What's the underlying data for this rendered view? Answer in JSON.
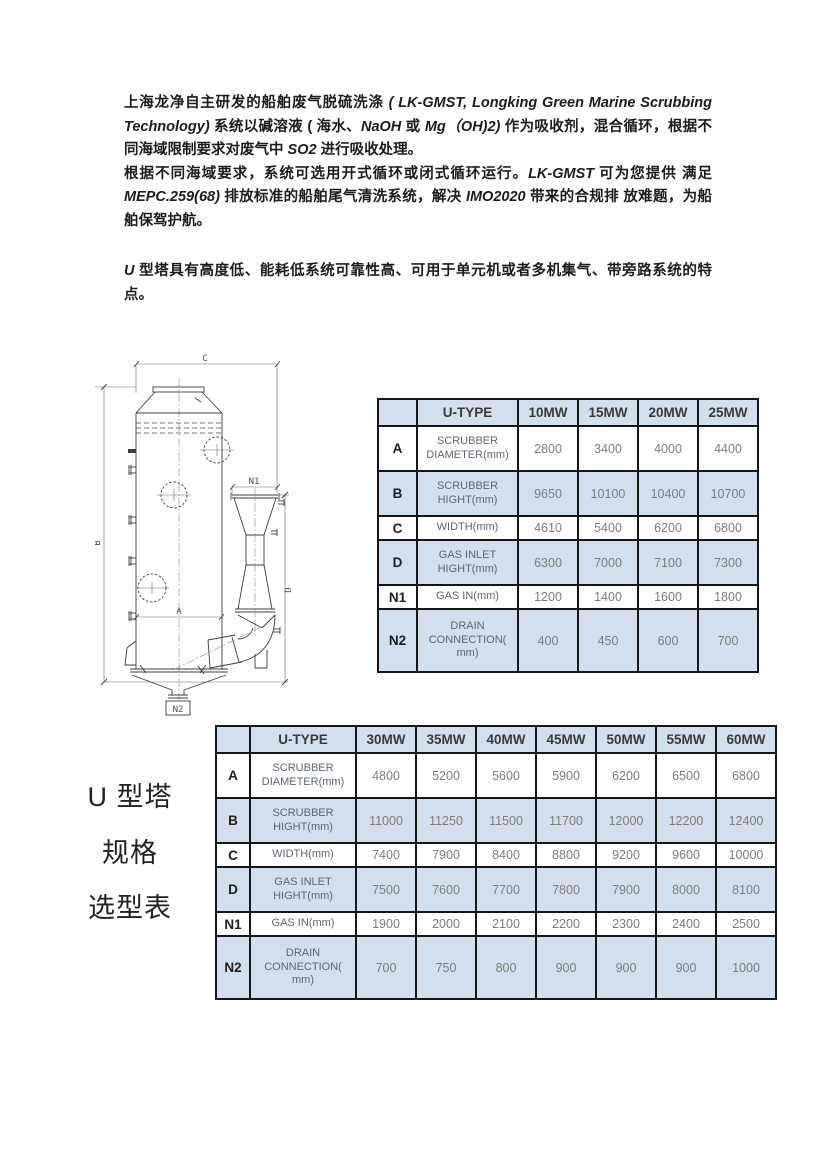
{
  "colors": {
    "table_header_bg": "#d3dfed",
    "shaded_row_bg": "#d3dfed",
    "table_border": "#161616",
    "body_text": "#1c1c1c",
    "value_text": "#7c7c7c"
  },
  "paragraphs": [
    {
      "segments": [
        {
          "t": "上海龙净自主研发的船舶废气脱硫洗涤 ",
          "i": false
        },
        {
          "t": "( LK-GMST, Longking Green Marine Scrubbing Technology)",
          "i": true
        },
        {
          "t": " 系统以碱溶液 ( 海水、",
          "i": false
        },
        {
          "t": "NaOH",
          "i": true
        },
        {
          "t": " 或 ",
          "i": false
        },
        {
          "t": "Mg（OH)2)",
          "i": true
        },
        {
          "t": " 作为吸收剂，混合循环，根据不同海域限制要求对废气中 ",
          "i": false
        },
        {
          "t": "SO2",
          "i": true
        },
        {
          "t": " 进行吸收处理。",
          "i": false
        }
      ]
    },
    {
      "segments": [
        {
          "t": "根据不同海域要求，系统可选用开式循环或闭式循环运行。",
          "i": false
        },
        {
          "t": "LK-GMST",
          "i": true
        },
        {
          "t": " 可为您提供 满足 ",
          "i": false
        },
        {
          "t": "MEPC.259(68)",
          "i": true
        },
        {
          "t": " 排放标准的船舶尾气清洗系统，解决 ",
          "i": false
        },
        {
          "t": "IMO2020",
          "i": true
        },
        {
          "t": " 带来的合规排 放难题，为船舶保驾护航。",
          "i": false
        }
      ]
    },
    {
      "segments": [
        {
          "t": "U",
          "i": true
        },
        {
          "t": " 型塔具有高度低、能耗低系统可靠性高、可用于单元机或者多机集气、带旁路系统的特点。",
          "i": false
        }
      ]
    }
  ],
  "drawing": {
    "labels": {
      "a": "A",
      "b": "B",
      "c": "C",
      "d": "D",
      "n1": "N1",
      "n2": "N2"
    }
  },
  "side_label": {
    "lines": [
      "U 型塔",
      "规格",
      "选型表"
    ]
  },
  "table1": {
    "columns": [
      "",
      "U-TYPE",
      "10MW",
      "15MW",
      "20MW",
      "25MW"
    ],
    "rows": [
      {
        "key": "A",
        "label": "SCRUBBER DIAMETER(mm)",
        "values": [
          "2800",
          "3400",
          "4000",
          "4400"
        ],
        "shaded": false
      },
      {
        "key": "B",
        "label": "SCRUBBER HIGHT(mm)",
        "values": [
          "9650",
          "10100",
          "10400",
          "10700"
        ],
        "shaded": true
      },
      {
        "key": "C",
        "label": "WIDTH(mm)",
        "values": [
          "4610",
          "5400",
          "6200",
          "6800"
        ],
        "shaded": false
      },
      {
        "key": "D",
        "label": "GAS INLET HIGHT(mm)",
        "values": [
          "6300",
          "7000",
          "7100",
          "7300"
        ],
        "shaded": true
      },
      {
        "key": "N1",
        "label": "GAS IN(mm)",
        "values": [
          "1200",
          "1400",
          "1600",
          "1800"
        ],
        "shaded": false
      },
      {
        "key": "N2",
        "label": "DRAIN CONNECTION( mm)",
        "values": [
          "400",
          "450",
          "600",
          "700"
        ],
        "shaded": true
      }
    ]
  },
  "table2": {
    "columns": [
      "",
      "U-TYPE",
      "30MW",
      "35MW",
      "40MW",
      "45MW",
      "50MW",
      "55MW",
      "60MW"
    ],
    "rows": [
      {
        "key": "A",
        "label": "SCRUBBER DIAMETER(mm)",
        "values": [
          "4800",
          "5200",
          "5600",
          "5900",
          "6200",
          "6500",
          "6800"
        ],
        "shaded": false
      },
      {
        "key": "B",
        "label": "SCRUBBER HIGHT(mm)",
        "values": [
          "11000",
          "11250",
          "11500",
          "11700",
          "12000",
          "12200",
          "12400"
        ],
        "shaded": true
      },
      {
        "key": "C",
        "label": "WIDTH(mm)",
        "values": [
          "7400",
          "7900",
          "8400",
          "8800",
          "9200",
          "9600",
          "10000"
        ],
        "shaded": false
      },
      {
        "key": "D",
        "label": "GAS INLET HIGHT(mm)",
        "values": [
          "7500",
          "7600",
          "7700",
          "7800",
          "7900",
          "8000",
          "8100"
        ],
        "shaded": true
      },
      {
        "key": "N1",
        "label": "GAS IN(mm)",
        "values": [
          "1900",
          "2000",
          "2100",
          "2200",
          "2300",
          "2400",
          "2500"
        ],
        "shaded": false
      },
      {
        "key": "N2",
        "label": "DRAIN CONNECTION( mm)",
        "values": [
          "700",
          "750",
          "800",
          "900",
          "900",
          "900",
          "1000"
        ],
        "shaded": true
      }
    ]
  }
}
